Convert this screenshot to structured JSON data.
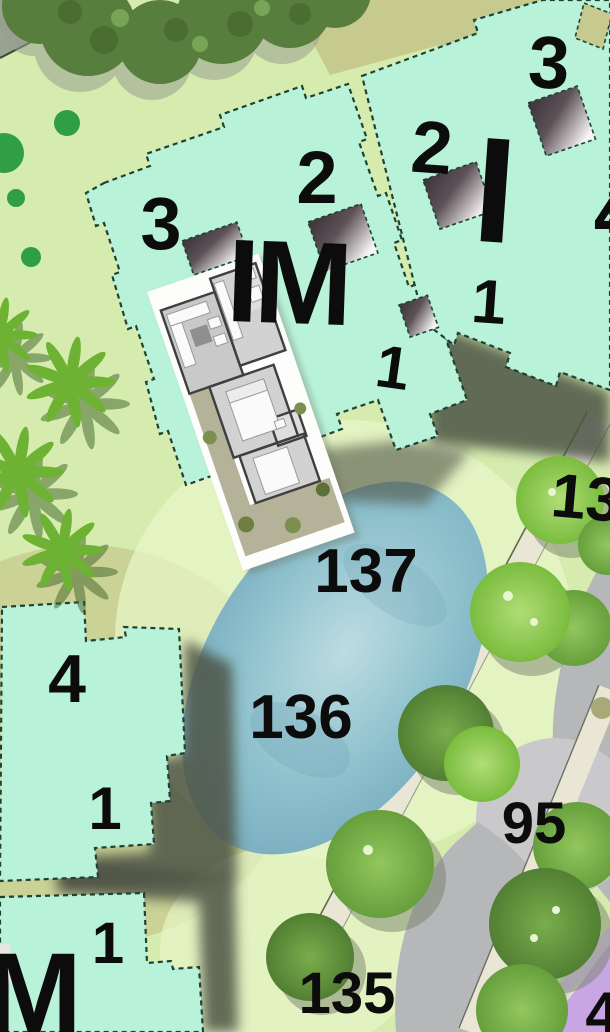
{
  "title": "Resort master plan with unit floor-plan overlay",
  "buildings": {
    "im": {
      "name": "IM",
      "f1": "1",
      "f2": "2",
      "f3": "3"
    },
    "i": {
      "name": "I",
      "f1": "1",
      "f2": "2",
      "f3": "3",
      "f4_partial": "4"
    },
    "four": {
      "f4": "4",
      "f1": "1"
    },
    "m": {
      "name": "M",
      "f1": "1"
    }
  },
  "lots": {
    "l137": "137",
    "l136": "136",
    "l135": "135",
    "l95": "95",
    "l13_partial": "13",
    "l4_partial": "4"
  },
  "icons": [
    "palm-tree-icon",
    "round-tree-icon",
    "canopy-tree-icon",
    "pond-shape",
    "road-shape",
    "sidewalk-path",
    "stair-shaft-icon",
    "floorplan-overlay"
  ],
  "colors": {
    "mint": "#b8f2d9",
    "bborder": "#1f4234",
    "grass": "#d5ecae",
    "grass_light": "#e7f5c8",
    "khaki": "#c6ca8e",
    "olive": "#c9cf92",
    "road": "#b6b7b9",
    "road_light": "#c9c9cb",
    "path_beige": "#eae6d6",
    "pond_edge": "#74a8bb",
    "pond_mid": "#8ec1cd",
    "pond_light": "#bcdce1",
    "tree_bright": "#7abc3e",
    "tree_medium": "#669f3c",
    "tree_dark": "#527f33",
    "canopy": "#587e3d",
    "palm": "#6db233",
    "palm_shadow": "#3f6026",
    "purple": "#c7a6e3",
    "purple_light": "#dcc8f0",
    "label": "#0c0c0c",
    "plan_wall": "#3f3f3f",
    "plan_room": "#d2d2d2",
    "plan_terrace": "#b5b29a",
    "shadow": "#4e5445"
  }
}
